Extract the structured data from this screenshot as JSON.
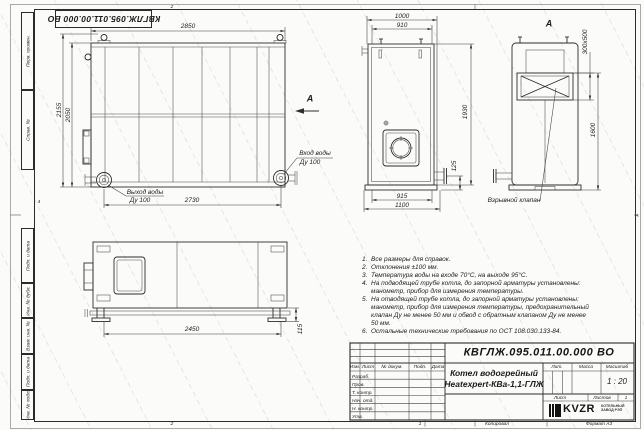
{
  "frame": {
    "doc_number_flipped": "КВГЛЖ.095.011.00.000 ВО",
    "side_labels": [
      "Перв. примен.",
      "Справ. №",
      "Подп. и дата",
      "Инв. № дубл.",
      "Взам. инв. №",
      "Подп. и дата",
      "Инв. № подл."
    ],
    "zones": {
      "top": "2",
      "bottom": "2",
      "bottom_right": "1",
      "left": "4",
      "right": "А"
    }
  },
  "top_view": {
    "dim_width_top": "2850",
    "dim_height_outer": "2155",
    "dim_height_inner": "2050",
    "dim_width_bottom": "2730",
    "outlet_label": "Выход воды",
    "outlet_dn": "Ду 100",
    "inlet_label": "Вход воды",
    "inlet_dn": "Ду 100",
    "section_arrow": "А"
  },
  "front_view": {
    "dim_top_outer": "1000",
    "dim_top_inner": "910",
    "dim_height": "1930",
    "dim_stub": "125",
    "dim_bottom_inner": "915",
    "dim_bottom_outer": "1100"
  },
  "view_a": {
    "title": "А",
    "dim_valve": "300x500",
    "dim_height": "1600",
    "callout": "Взрывной клапан"
  },
  "side_view": {
    "dim_length": "2450",
    "dim_foot": "115"
  },
  "notes": {
    "items": [
      {
        "num": "1.",
        "text": "Все размеры для справок."
      },
      {
        "num": "2.",
        "text": "Отклонения ±100 мм."
      },
      {
        "num": "3.",
        "text": "Температура воды на входе 70°С, на выходе 95°С."
      },
      {
        "num": "4.",
        "text": "На подводящей трубе котла, до запорной арматуры установлены: манометр, прибор для измерения температуры."
      },
      {
        "num": "5.",
        "text": "На отводящей трубе котла, до запорной арматуры установлены: манометр, прибор для измерения температуры, предохранительный клапан Ду не менее 50 мм и обвод с обратным клапаном Ду не менее 50 мм."
      },
      {
        "num": "6.",
        "text": "Остальные технические требования по ОСТ 108.030.133-84."
      }
    ]
  },
  "title_block": {
    "doc_number": "КВГЛЖ.095.011.00.000 ВО",
    "product_name_line1": "Котел водогрейный",
    "product_name_line2": "Heatexpert-КВа-1,1-ГЛЖ",
    "col_headers": [
      "Изм.",
      "Лист",
      "№ докум.",
      "Подп.",
      "Дата"
    ],
    "row_labels": [
      "Разраб.",
      "Пров.",
      "Т. контр.",
      "Нач. отд.",
      "Н. контр.",
      "Утв."
    ],
    "lit_label": "Лит.",
    "mass_label": "Масса",
    "scale_label": "Масштаб",
    "scale_value": "1 : 20",
    "sheet_label": "Лист",
    "sheets_label": "Листов",
    "sheets_value": "1",
    "logo_text": "KVZR",
    "org_text_line1": "КОТЕЛЬНЫЙ",
    "org_text_line2": "ЗАВОД РЭП",
    "copied_label": "Копировал",
    "format_label": "Формат А3"
  }
}
